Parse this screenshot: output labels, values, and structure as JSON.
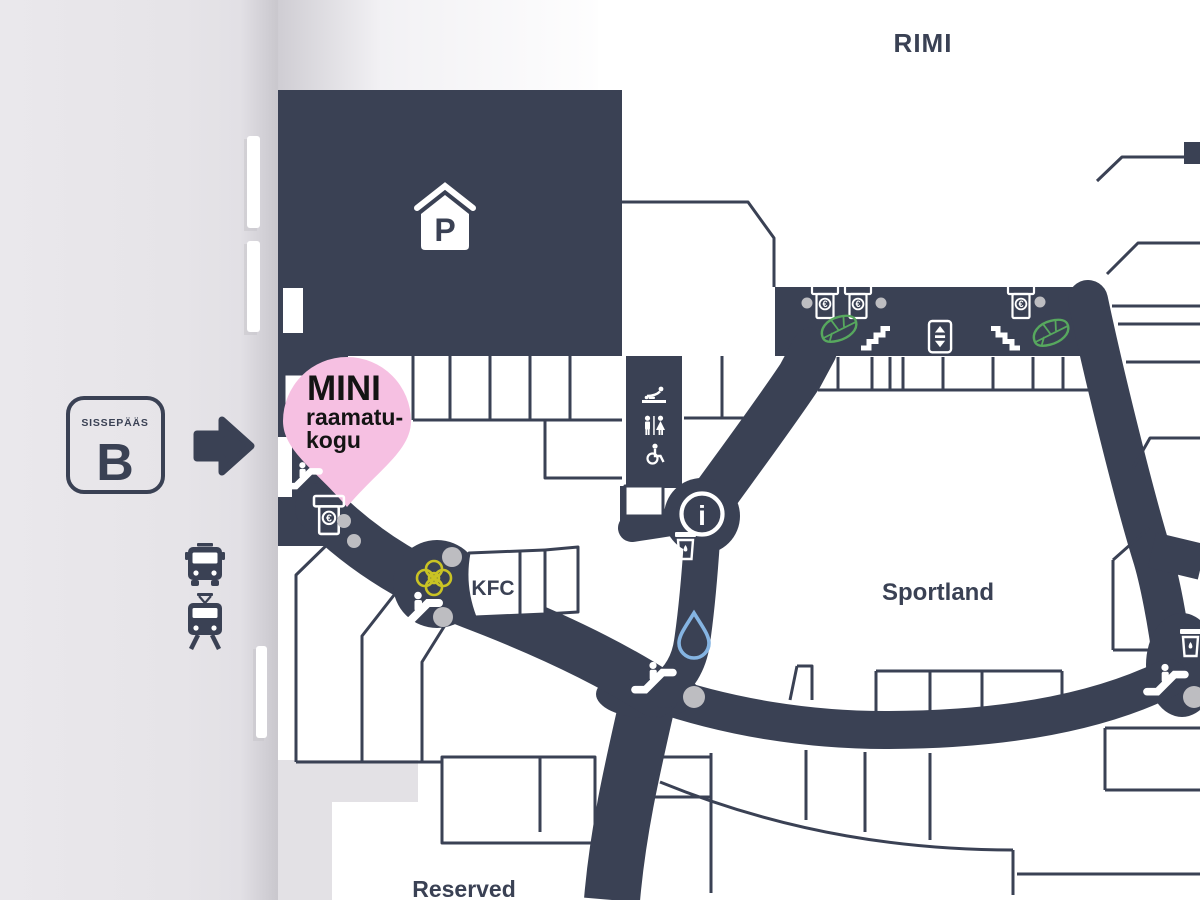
{
  "map_labels": {
    "rimi": "RIMI",
    "kfc": "KFC",
    "sportland": "Sportland",
    "reserved": "Reserved"
  },
  "location_pin": {
    "line1": "MINI",
    "line2": "raamatu-",
    "line3": "kogu"
  },
  "entrance_sign": {
    "label": "SISSEPÄÄS",
    "letter": "B"
  },
  "symbols": {
    "parking_letter": "P",
    "info_letter": "i",
    "atm_currency": "€"
  },
  "colors": {
    "dark": "#3a4154",
    "pin_pink": "#f6c0e2",
    "leaf_green": "#57a85e",
    "flower_yellow": "#c9c324",
    "water_blue": "#85b4e2",
    "pillar_gray": "#bdbdc1",
    "bg_gray": "#eae8ec",
    "text_black": "#141414"
  },
  "icons": [
    "parking-icon",
    "atm-icon",
    "escalator-icon",
    "stairs-up-icon",
    "stairs-down-icon",
    "elevator-icon",
    "leaf-icon",
    "flower-icon",
    "water-fountain-icon",
    "trash-icon",
    "info-icon",
    "wc-icon",
    "baby-change-icon",
    "wheelchair-icon",
    "pillar-dot",
    "entrance-arrow-icon",
    "bus-icon",
    "tram-icon",
    "location-pin"
  ]
}
